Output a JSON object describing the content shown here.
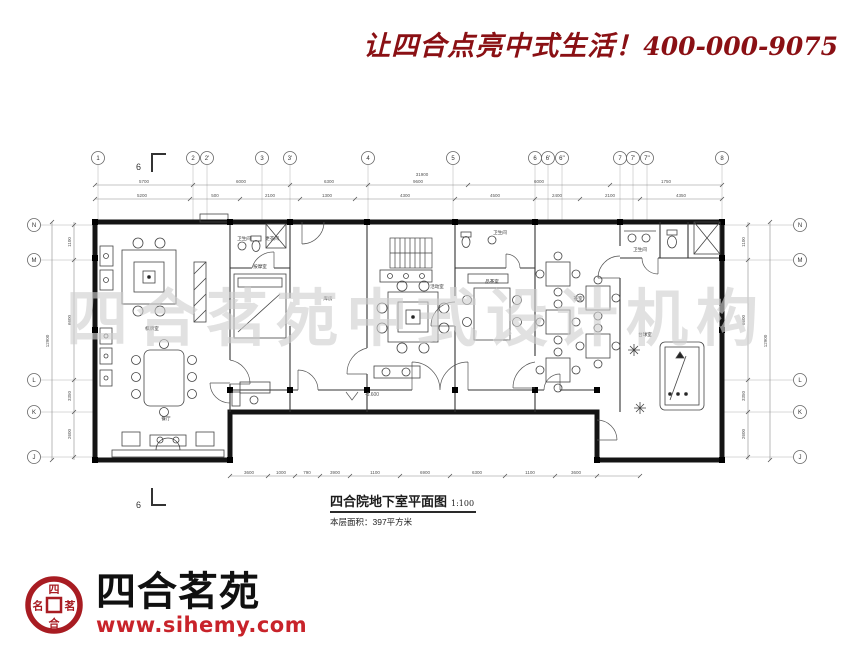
{
  "header": {
    "slogan": "让四合点亮中式生活！",
    "phone": "400-000-9075",
    "accent_color": "#8a1014"
  },
  "watermark": "四合茗苑中式设计机构",
  "title_block": {
    "title": "四合院地下室平面图",
    "scale": "1:100",
    "area": "本层面积：397平方米"
  },
  "logo": {
    "name": "四合茗苑",
    "url": "www.sihemy.com",
    "seal": {
      "top": "四",
      "right": "茗",
      "bottom": "合",
      "left": "名"
    },
    "seal_color": "#a81c22",
    "url_color": "#c8232a"
  },
  "plan": {
    "markers": {
      "section": "6",
      "level": "-3.600"
    },
    "grid": {
      "top": [
        "1",
        "2",
        "2'",
        "3",
        "3'",
        "4",
        "5",
        "6",
        "6'",
        "6''",
        "7",
        "7'",
        "7''",
        "8"
      ],
      "left": [
        "N",
        "M",
        "L",
        "K",
        "J"
      ],
      "right": [
        "N",
        "M",
        "L",
        "K",
        "J"
      ]
    },
    "dims": {
      "top_total": "31900",
      "top_row1": [
        "5700",
        "6000",
        "6300",
        "9600",
        "6000",
        "1750"
      ],
      "top_row2": [
        "5200",
        "500",
        "2100",
        "1300",
        "4300",
        "4500",
        "2400",
        "2100",
        "4350"
      ],
      "bottom": [
        "3600",
        "1000",
        "790",
        "3900",
        "1100",
        "6900",
        "6300",
        "1100",
        "3600"
      ],
      "left": [
        "1100",
        "6600",
        "3350",
        "2600"
      ],
      "left_total": "12900",
      "right": [
        "1100",
        "6600",
        "3350",
        "2600"
      ],
      "right_total": "12900"
    },
    "rooms": [
      "卫生间",
      "更衣间",
      "按摩室",
      "库房",
      "活动室",
      "卫生间",
      "品茶室",
      "茶室",
      "卫生间",
      "台球室",
      "棋牌室",
      "餐厅"
    ]
  }
}
